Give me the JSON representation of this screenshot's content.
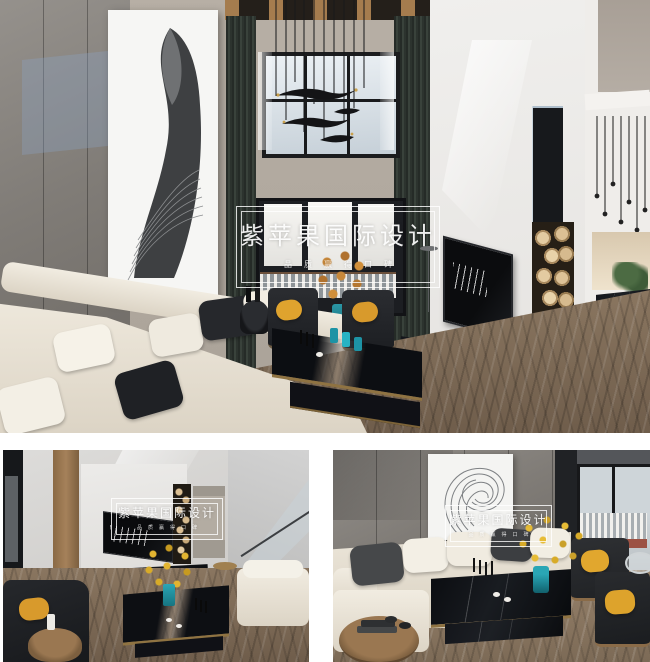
{
  "page": {
    "background_color": "#ffffff",
    "layout": "one large photo above two smaller photos"
  },
  "watermark": {
    "title": "紫苹果国际设计",
    "tagline": "品质赢得口碑",
    "style": "double white outlined rectangle, centered"
  },
  "photos": [
    {
      "name": "living-room-main-view",
      "description": "Double-height living room: gray concrete feature wall with large abstract artwork, tall black-framed windows with dark curtains, swallow-style chandelier, cream sectional sofa with black and white pillows, black armchairs with yellow cushions, black marble coffee table, white fireplace wall with firewood niche, dining nook with pendant lights, chevron wood floor"
    },
    {
      "name": "living-room-tv-wall-view",
      "description": "View toward fireplace TV wall and staircase with glass railing, black armchair with yellow cushion, marble coffee table with yellow flowers, white sofa, chevron wood floor"
    },
    {
      "name": "living-room-sofa-view",
      "description": "Cream corner sofa against concrete wall with abstract spiral artwork, black wood armchairs with yellow cushions, marble coffee table with yellow flowers in teal vase, balcony door, round wood side table with books, chevron wood floor"
    }
  ],
  "palette": {
    "accent_yellow": "#dfa32e",
    "teal_glass": "#2596a8",
    "concrete_gray": "#817d78",
    "wood_floor": "#7d6a56",
    "curtain_green_black": "#2e352f",
    "marble_black": "#14161b",
    "sofa_cream": "#eae4d7",
    "wall_white": "#edecea",
    "wood_beam_tan": "#a57c4e"
  }
}
